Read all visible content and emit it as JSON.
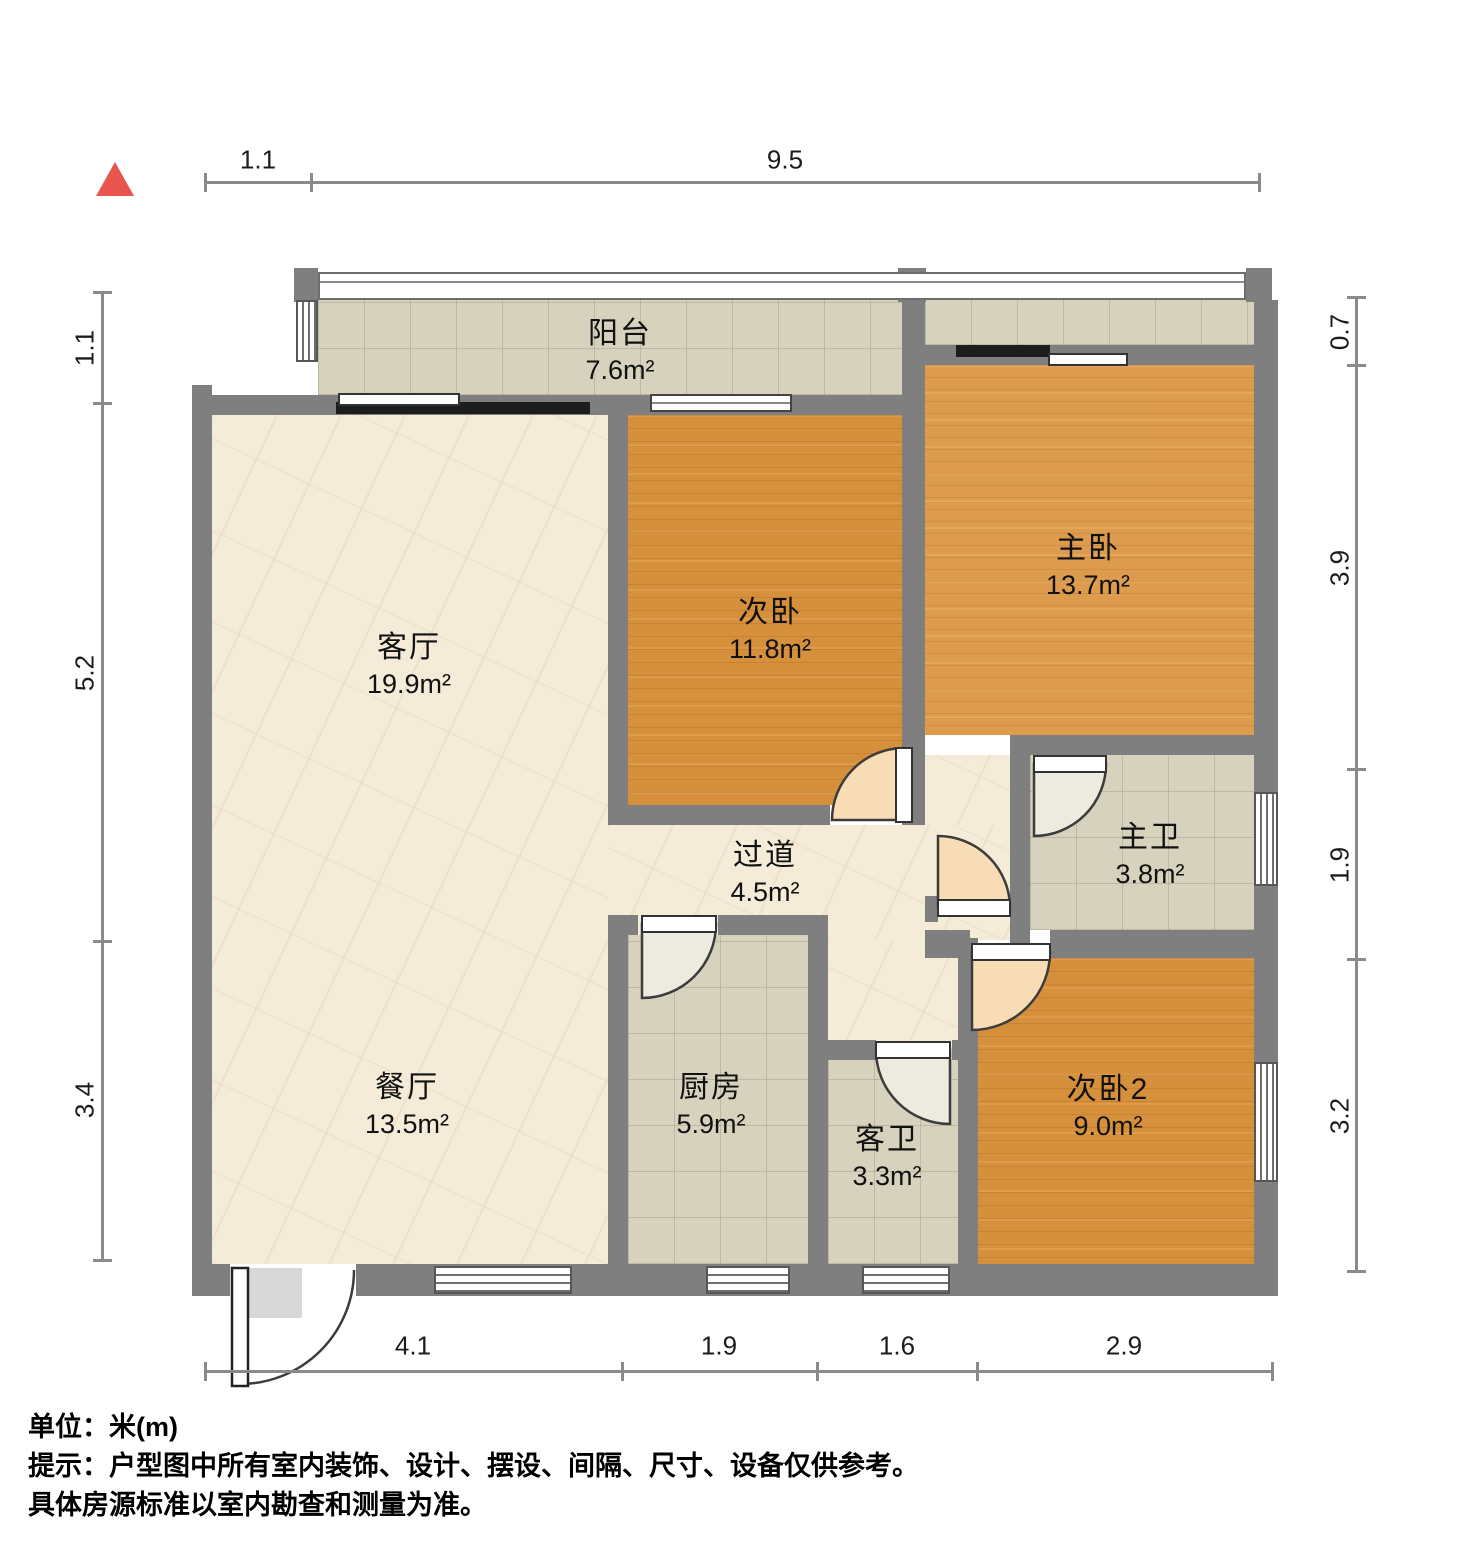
{
  "rooms": [
    {
      "name": "阳台",
      "area": "7.6m²"
    },
    {
      "name": "客厅",
      "area": "19.9m²"
    },
    {
      "name": "次卧",
      "area": "11.8m²"
    },
    {
      "name": "主卧",
      "area": "13.7m²"
    },
    {
      "name": "主卫",
      "area": "3.8m²"
    },
    {
      "name": "过道",
      "area": "4.5m²"
    },
    {
      "name": "餐厅",
      "area": "13.5m²"
    },
    {
      "name": "厨房",
      "area": "5.9m²"
    },
    {
      "name": "客卫",
      "area": "3.3m²"
    },
    {
      "name": "次卧2",
      "area": "9.0m²"
    }
  ],
  "dims": {
    "top": [
      "1.1",
      "9.5"
    ],
    "left": [
      "1.1",
      "5.2",
      "3.4"
    ],
    "right": [
      "0.7",
      "3.9",
      "1.9",
      "3.2"
    ],
    "bottom": [
      "4.1",
      "1.9",
      "1.6",
      "2.9"
    ]
  },
  "notes": {
    "unit": "单位：米(m)",
    "tip1": "提示：户型图中所有室内装饰、设计、摆设、间隔、尺寸、设备仅供参考。",
    "tip2": "具体房源标准以室内勘查和测量为准。"
  },
  "colors": {
    "wall": "#7f7f7f",
    "wood": "#d6903c",
    "wood_light": "#dd9b4d",
    "tile": "#d6d2bd",
    "marble": "#f4ebd9",
    "swing": "#f8dcb6",
    "bath_swing": "#edeadf",
    "track": "#1d1d1d",
    "north": "#e8544e",
    "dim": "#8a8a8a",
    "text": "#111111"
  }
}
